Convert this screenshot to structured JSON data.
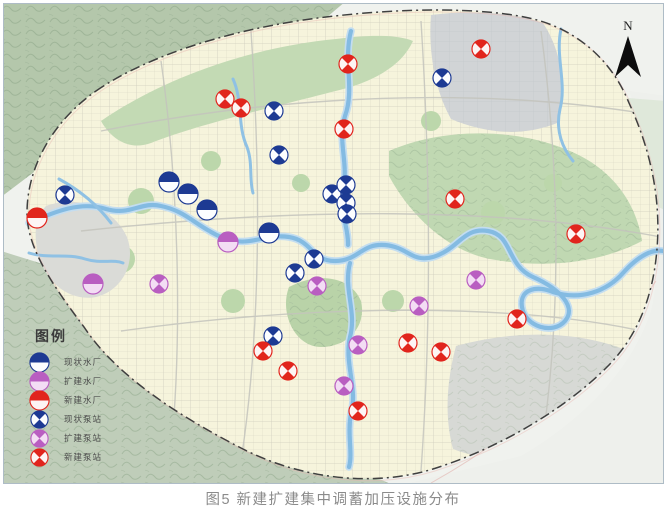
{
  "figure": {
    "caption": "图5 新建扩建集中调蓄加压设施分布"
  },
  "map": {
    "north_label": "N",
    "legend": {
      "title": "图例",
      "items": [
        {
          "id": "existing-plant",
          "label": "现状水厂",
          "kind": "plant",
          "status": "existing"
        },
        {
          "id": "expanded-plant",
          "label": "扩建水厂",
          "kind": "plant",
          "status": "expanded"
        },
        {
          "id": "new-plant",
          "label": "新建水厂",
          "kind": "plant",
          "status": "new"
        },
        {
          "id": "existing-pump",
          "label": "现状泵站",
          "kind": "pump",
          "status": "existing"
        },
        {
          "id": "expanded-pump",
          "label": "扩建泵站",
          "kind": "pump",
          "status": "expanded"
        },
        {
          "id": "new-pump",
          "label": "新建泵站",
          "kind": "pump",
          "status": "new"
        }
      ]
    },
    "colors": {
      "existing": {
        "main": "#1d3a93",
        "light": "#fcfdff"
      },
      "expanded": {
        "main": "#b95ec1",
        "light": "#f3ddf4"
      },
      "new": {
        "main": "#e1251d",
        "light": "#fdf4f4"
      }
    },
    "markers": [
      {
        "category": "existing-plant",
        "x": 168,
        "y": 181
      },
      {
        "category": "existing-plant",
        "x": 187,
        "y": 193
      },
      {
        "category": "existing-plant",
        "x": 206,
        "y": 209
      },
      {
        "category": "existing-plant",
        "x": 268,
        "y": 232
      },
      {
        "category": "expanded-plant",
        "x": 227,
        "y": 241
      },
      {
        "category": "expanded-plant",
        "x": 92,
        "y": 283
      },
      {
        "category": "new-plant",
        "x": 36,
        "y": 217
      },
      {
        "category": "existing-pump",
        "x": 273,
        "y": 110
      },
      {
        "category": "existing-pump",
        "x": 278,
        "y": 154
      },
      {
        "category": "existing-pump",
        "x": 64,
        "y": 194
      },
      {
        "category": "existing-pump",
        "x": 441,
        "y": 77
      },
      {
        "category": "existing-pump",
        "x": 331,
        "y": 193
      },
      {
        "category": "existing-pump",
        "x": 345,
        "y": 184
      },
      {
        "category": "existing-pump",
        "x": 345,
        "y": 202
      },
      {
        "category": "existing-pump",
        "x": 346,
        "y": 213
      },
      {
        "category": "existing-pump",
        "x": 313,
        "y": 258
      },
      {
        "category": "existing-pump",
        "x": 294,
        "y": 272
      },
      {
        "category": "existing-pump",
        "x": 272,
        "y": 335
      },
      {
        "category": "expanded-pump",
        "x": 158,
        "y": 283
      },
      {
        "category": "expanded-pump",
        "x": 316,
        "y": 285
      },
      {
        "category": "expanded-pump",
        "x": 475,
        "y": 279
      },
      {
        "category": "expanded-pump",
        "x": 418,
        "y": 305
      },
      {
        "category": "expanded-pump",
        "x": 357,
        "y": 344
      },
      {
        "category": "expanded-pump",
        "x": 343,
        "y": 385
      },
      {
        "category": "new-pump",
        "x": 224,
        "y": 98
      },
      {
        "category": "new-pump",
        "x": 240,
        "y": 107
      },
      {
        "category": "new-pump",
        "x": 347,
        "y": 63
      },
      {
        "category": "new-pump",
        "x": 480,
        "y": 48
      },
      {
        "category": "new-pump",
        "x": 343,
        "y": 128
      },
      {
        "category": "new-pump",
        "x": 454,
        "y": 198
      },
      {
        "category": "new-pump",
        "x": 575,
        "y": 233
      },
      {
        "category": "new-pump",
        "x": 516,
        "y": 318
      },
      {
        "category": "new-pump",
        "x": 262,
        "y": 350
      },
      {
        "category": "new-pump",
        "x": 287,
        "y": 370
      },
      {
        "category": "new-pump",
        "x": 407,
        "y": 342
      },
      {
        "category": "new-pump",
        "x": 440,
        "y": 351
      },
      {
        "category": "new-pump",
        "x": 357,
        "y": 410
      }
    ]
  }
}
